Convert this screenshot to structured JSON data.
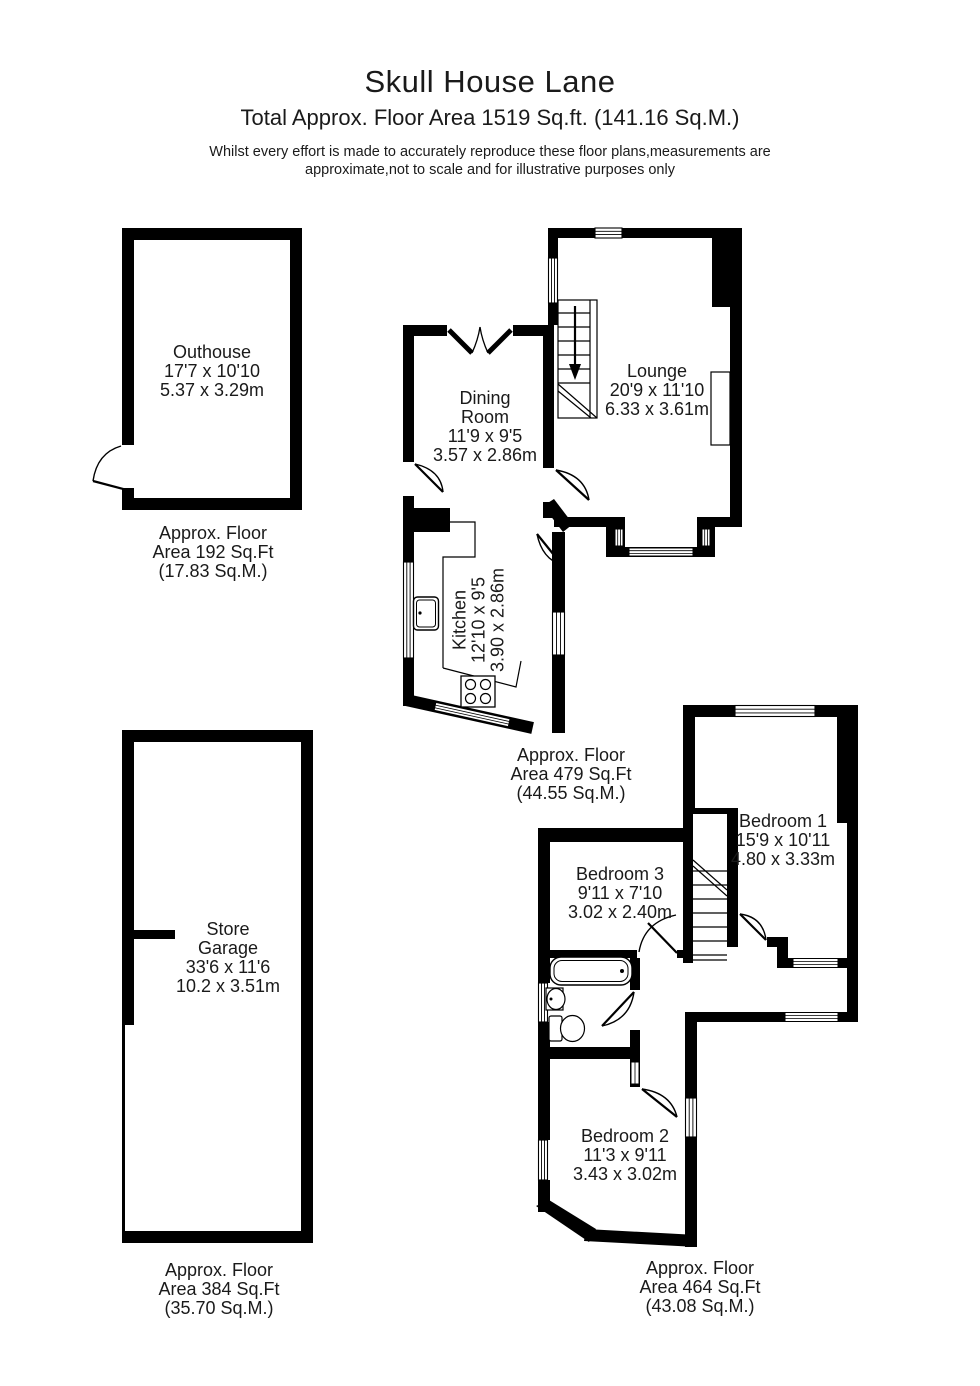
{
  "header": {
    "title": "Skull House Lane",
    "subtitle": "Total Approx. Floor Area 1519 Sq.ft. (141.16 Sq.M.)",
    "disclaimer": [
      "Whilst every effort is made to accurately reproduce these floor plans,measurements are",
      "approximate,not to scale and for illustrative purposes only"
    ]
  },
  "rooms": {
    "outhouse": {
      "lines": [
        "Outhouse",
        "17'7 x 10'10",
        "5.37 x 3.29m"
      ]
    },
    "dining": {
      "lines": [
        "Dining",
        "Room",
        "11'9 x 9'5",
        "3.57 x 2.86m"
      ]
    },
    "lounge": {
      "lines": [
        "Lounge",
        "20'9 x 11'10",
        "6.33 x 3.61m"
      ]
    },
    "kitchen": {
      "lines": [
        "Kitchen",
        "12'10 x 9'5",
        "3.90 x 2.86m"
      ]
    },
    "garage": {
      "lines": [
        "Store",
        "Garage",
        "33'6 x 11'6",
        "10.2 x 3.51m"
      ]
    },
    "bedroom1": {
      "lines": [
        "Bedroom 1",
        "15'9 x 10'11",
        "4.80 x 3.33m"
      ]
    },
    "bedroom2": {
      "lines": [
        "Bedroom 2",
        "11'3 x 9'11",
        "3.43 x 3.02m"
      ]
    },
    "bedroom3": {
      "lines": [
        "Bedroom 3",
        "9'11 x 7'10",
        "3.02 x 2.40m"
      ]
    }
  },
  "areas": {
    "outhouse": {
      "lines": [
        "Approx. Floor",
        "Area 192 Sq.Ft",
        "(17.83 Sq.M.)"
      ]
    },
    "ground": {
      "lines": [
        "Approx. Floor",
        "Area 479 Sq.Ft",
        "(44.55 Sq.M.)"
      ]
    },
    "garage": {
      "lines": [
        "Approx. Floor",
        "Area 384 Sq.Ft",
        "(35.70 Sq.M.)"
      ]
    },
    "first": {
      "lines": [
        "Approx. Floor",
        "Area 464 Sq.Ft",
        "(43.08 Sq.M.)"
      ]
    }
  },
  "colors": {
    "wall": "#000000",
    "background": "#ffffff",
    "text": "#1a1a1a"
  }
}
